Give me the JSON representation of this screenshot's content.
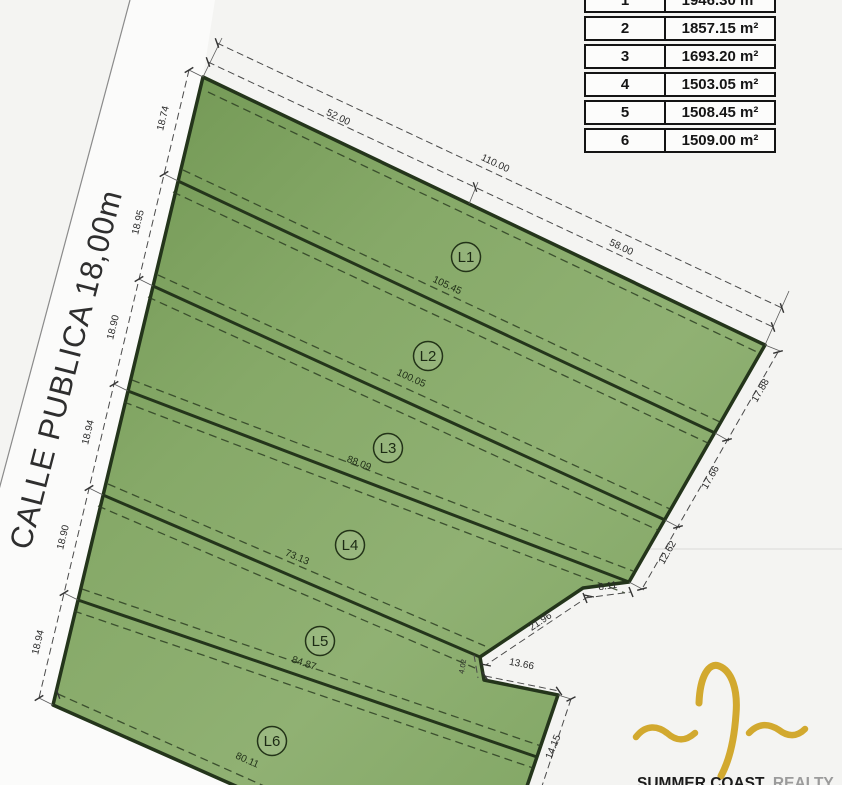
{
  "street_label": "CALLE PUBLICA 18,00m",
  "area_table": {
    "rows": [
      {
        "lot": "1",
        "area": "1946.30 m²"
      },
      {
        "lot": "2",
        "area": "1857.15 m²"
      },
      {
        "lot": "3",
        "area": "1693.20 m²"
      },
      {
        "lot": "4",
        "area": "1503.05 m²"
      },
      {
        "lot": "5",
        "area": "1508.45 m²"
      },
      {
        "lot": "6",
        "area": "1509.00 m²"
      }
    ]
  },
  "lot_labels": [
    "L1",
    "L2",
    "L3",
    "L4",
    "L5",
    "L6"
  ],
  "dims": {
    "top": [
      "52.00",
      "110.00",
      "58.00"
    ],
    "frontage": [
      "18.74",
      "18.95",
      "18.90",
      "18.94",
      "18.90",
      "18.94"
    ],
    "right": [
      "17.88",
      "17.66",
      "12.62"
    ],
    "notch": [
      "8.11",
      "21.96",
      "4.02",
      "13.66",
      "14.15"
    ],
    "interior": [
      "105.45",
      "100.05",
      "88.09",
      "73.13",
      "84.87",
      "80.11"
    ]
  },
  "logo": {
    "name_bold": "SUMMER COAST",
    "name_light": "REALTY"
  },
  "colors": {
    "parcel_green": "#84a566",
    "parcel_green_dark": "#6f9551",
    "outline_dark": "#24351b",
    "logo_gold": "#d2a92f",
    "table_border": "#141414"
  }
}
